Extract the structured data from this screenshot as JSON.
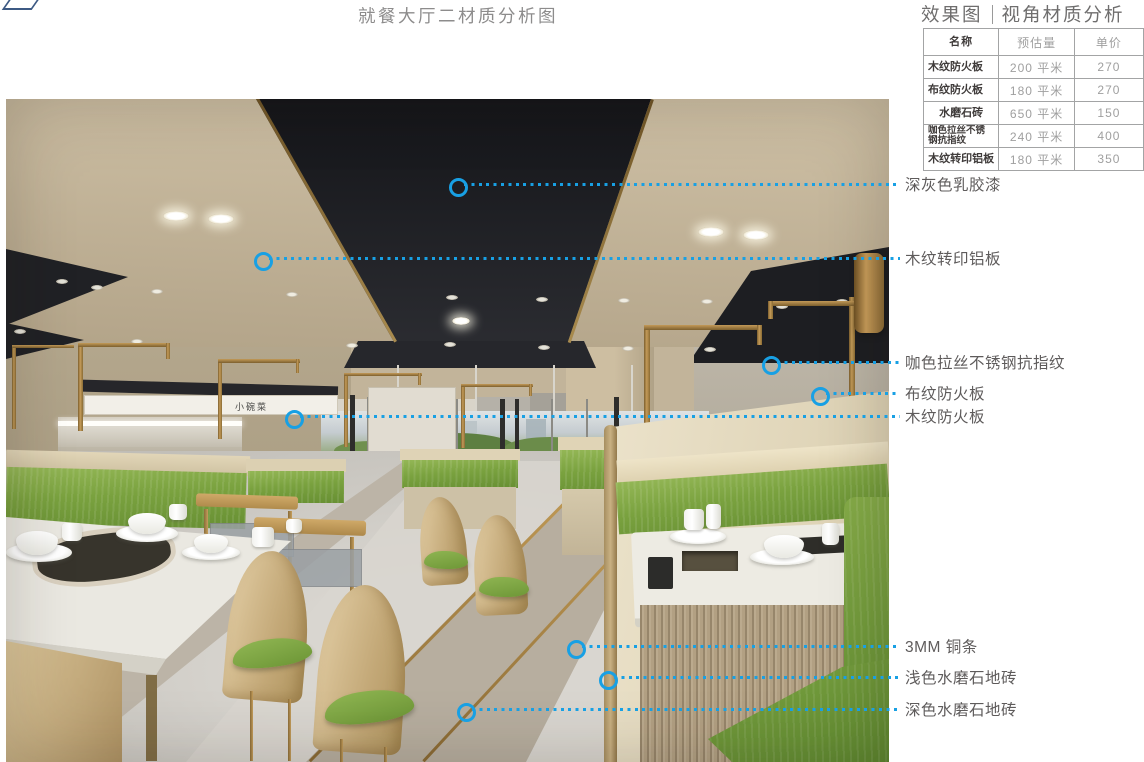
{
  "page_title": "就餐大厅二材质分析图",
  "panel": {
    "title_left": "效果图",
    "title_right": "视角材质分析",
    "table": {
      "headers": [
        "名称",
        "预估量",
        "单价"
      ],
      "rows": [
        {
          "name": "木纹防火板",
          "qty": "200 平米",
          "price": "270",
          "align": "left"
        },
        {
          "name": "布纹防火板",
          "qty": "180 平米",
          "price": "270",
          "align": "left"
        },
        {
          "name": "水磨石砖",
          "qty": "650 平米",
          "price": "150",
          "align": "center"
        },
        {
          "name": "咖色拉丝不锈钢抗指纹",
          "qty": "240 平米",
          "price": "400",
          "align": "left"
        },
        {
          "name": "木纹转印铝板",
          "qty": "180 平米",
          "price": "350",
          "align": "center"
        }
      ]
    }
  },
  "annotations": [
    {
      "label": "深灰色乳胶漆",
      "x": 455,
      "y": 184
    },
    {
      "label": "木纹转印铝板",
      "x": 260,
      "y": 258
    },
    {
      "label": "咖色拉丝不锈钢抗指纹",
      "x": 768,
      "y": 362
    },
    {
      "label": "布纹防火板",
      "x": 817,
      "y": 393
    },
    {
      "label": "木纹防火板",
      "x": 291,
      "y": 416
    },
    {
      "label": "3MM 铜条",
      "x": 573,
      "y": 646
    },
    {
      "label": "浅色水磨石地砖",
      "x": 605,
      "y": 677
    },
    {
      "label": "深色水磨石地砖",
      "x": 463,
      "y": 709
    }
  ],
  "scene": {
    "sign_text": "小碗菜"
  },
  "colors": {
    "accent_blue": "#18a0e4",
    "annotation_text": "#5e5b5b",
    "ceiling_black": "#232428",
    "booth_green": "#77a23f",
    "brass": "#a8834a",
    "table_border": "#a3a4a5"
  }
}
